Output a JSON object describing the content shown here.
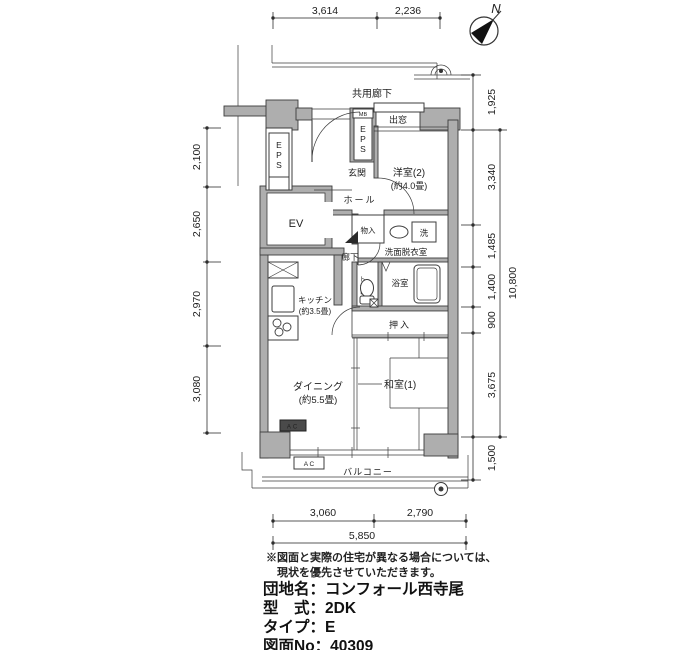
{
  "compass": {
    "north": "N"
  },
  "labels": {
    "corridor": "共用廊下",
    "eps_top": "EPS",
    "mb": "MB",
    "eps_left": "EPS",
    "ev": "EV",
    "genkan": "玄関",
    "hall": "ホール",
    "bay_window": "出窓",
    "western_room2": "洋室(2)",
    "western_room2_size": "(約4.0畳)",
    "storage": "物入",
    "washer": "洗",
    "washroom": "洗面脱衣室",
    "corridor_inner": "廊下",
    "toilet": "トイレ",
    "bathroom": "浴室",
    "closet": "押入",
    "kitchen": "キッチン",
    "kitchen_size": "(約3.5畳)",
    "dining": "ダイニング",
    "dining_size": "(約5.5畳)",
    "japanese_room1": "和室(1)",
    "balcony": "バルコニー",
    "ac_indoor": "AC",
    "ac_outdoor": "A C"
  },
  "dimensions": {
    "top": [
      "3,614",
      "2,236"
    ],
    "left": [
      "2,100",
      "2,650",
      "2,970",
      "3,080"
    ],
    "right": [
      "1,925",
      "3,340",
      "1,485",
      "1,400",
      "900",
      "3,675",
      "1,500"
    ],
    "right_total": "10,800",
    "bottom": [
      "3,060",
      "2,790"
    ],
    "bottom_total": "5,850"
  },
  "notes": [
    "※図面と実際の住宅が異なる場合については、",
    "現状を優先させていただきます。"
  ],
  "info_lines": [
    "団地名：コンフォール西寺尾",
    "型　式：2DK",
    "タイプ：E",
    "図面No：40309"
  ]
}
